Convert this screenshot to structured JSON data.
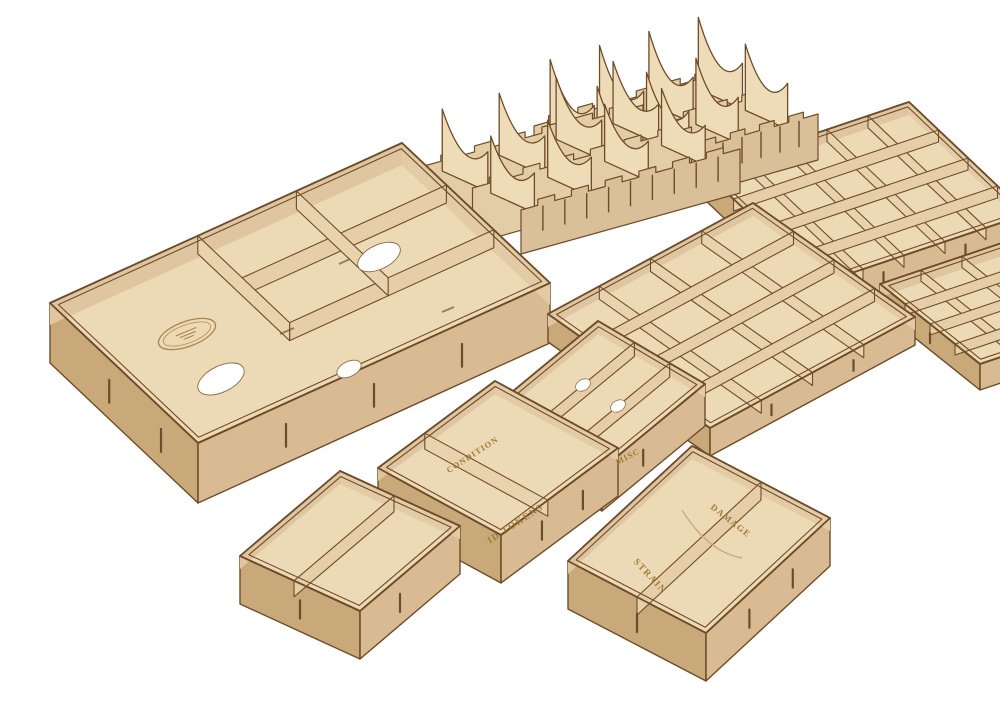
{
  "image": {
    "subject": "Laser-cut wooden board game box organizer set on white background",
    "background": "#ffffff"
  },
  "palette": {
    "background": "#ffffff",
    "wood_floor": "#ecd9b5",
    "wood_wall_inner": "#dfc6a0",
    "wood_wall_front": "#d8bb92",
    "wood_wall_side": "#c9a97a",
    "wood_divider": "#e6cfa8",
    "wood_fin": "#eedcb8",
    "burn_edge": "#6f4c29",
    "engraving": "#9c752f"
  },
  "engravings": {
    "condition": "CONDITION",
    "id_tokens": "ID TOKENS",
    "misc": "MISC",
    "damage": "DAMAGE",
    "strain": "STRAIN"
  },
  "components": [
    {
      "name": "large-box-insert",
      "labels": [],
      "features": [
        "oval-logo-engraving",
        "oval-finger-holes",
        "divided-compartments"
      ]
    },
    {
      "name": "card-holder-comb-left",
      "labels": [],
      "features": [
        "scalloped-card-slots",
        "finger-joint-teeth"
      ]
    },
    {
      "name": "card-holder-comb-right",
      "labels": [],
      "features": [
        "scalloped-card-slots",
        "finger-joint-teeth"
      ]
    },
    {
      "name": "grid-tray-16-compartments",
      "labels": [],
      "features": [
        "4x4-grid"
      ]
    },
    {
      "name": "grid-tray-20-compartments",
      "labels": [],
      "features": [
        "5x4-grid"
      ]
    },
    {
      "name": "grid-tray-partial-right-edge",
      "labels": [],
      "features": [
        "grid-cut-off-by-image-edge"
      ]
    },
    {
      "name": "small-tray-two-compartments",
      "labels": [],
      "features": [
        "single-divider"
      ]
    },
    {
      "name": "tray-condition-id-tokens",
      "labels": [
        "CONDITION",
        "ID TOKENS"
      ],
      "features": [
        "single-divider"
      ]
    },
    {
      "name": "tray-misc-three-rows",
      "labels": [
        "MISC"
      ],
      "features": [
        "two-dividers",
        "notch-cutouts"
      ]
    },
    {
      "name": "tray-damage-strain",
      "labels": [
        "DAMAGE",
        "STRAIN"
      ],
      "features": [
        "single-divider",
        "curved-cut-mark"
      ]
    }
  ]
}
